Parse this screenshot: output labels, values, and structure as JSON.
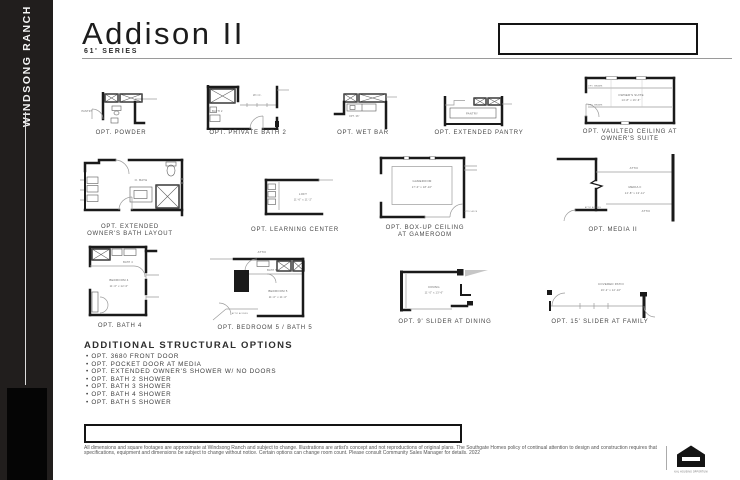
{
  "sidebar": {
    "brand": "WINDSONG RANCH"
  },
  "header": {
    "title": "Addison II",
    "series": "61' SERIES"
  },
  "plans": {
    "powder": {
      "caption": "OPT. POWDER",
      "pantry": "PANTRY"
    },
    "private_bath2": {
      "caption": "OPT. PRIVATE BATH 2",
      "wic": "W.I.C.",
      "bath": "BATH 2"
    },
    "wet_bar": {
      "caption": "OPT. WET BAR",
      "note": "OPT. 36\""
    },
    "ext_pantry": {
      "caption": "OPT. EXTENDED PANTRY",
      "pantry": "PANTRY"
    },
    "vaulted": {
      "caption_1": "OPT. VAULTED CEILING AT",
      "caption_2": "OWNER'S SUITE",
      "room": "OWNER'S SUITE",
      "dims": "14'-8\" x 16'-6\"",
      "beams_top": "OPT. BEAMS",
      "beams_bottom": "OPT. BEAMS"
    },
    "owners_bath": {
      "caption_1": "OPT. EXTENDED",
      "caption_2": "OWNER'S BATH LAYOUT",
      "room": "O. BATH"
    },
    "learning": {
      "caption": "OPT. LEARNING CENTER",
      "room": "LOFT",
      "dims": "11'-6\" x 11'-2\""
    },
    "gameroom": {
      "caption_1": "OPT. BOX-UP CEILING",
      "caption_2": "AT GAMEROOM",
      "room": "GAMEROOM",
      "dims": "17'-0\" x 18'-10\"",
      "attic_access": "ATTIC ACCESS"
    },
    "media2": {
      "caption": "OPT. MEDIA II",
      "room": "MEDIA II",
      "dims": "14'-8\" x 13'-11\"",
      "attic_top": "ATTIC",
      "attic_bottom": "ATTIC",
      "attic_access": "ATTIC ACCESS"
    },
    "bath4": {
      "caption": "OPT. BATH 4",
      "bath": "BATH 4",
      "room": "BEDROOM 4",
      "dims": "11'-0\" x 12'-0\""
    },
    "bedroom5": {
      "caption": "OPT. BEDROOM 5 / BATH 5",
      "attic": "ATTIC",
      "bath": "BATH 5",
      "room": "BEDROOM 5",
      "dims": "11'-0\" x 11'-0\"",
      "attic_access": "ATTIC ACCESS"
    },
    "slider_dining": {
      "caption": "OPT. 9' SLIDER AT DINING",
      "room": "DINING",
      "dims": "11'-0\" x 13'-6\""
    },
    "slider_family": {
      "caption": "OPT. 15' SLIDER AT FAMILY",
      "room": "COVERED PATIO",
      "dims": "16'-2\" x 12'-10\""
    }
  },
  "options": {
    "heading": "ADDITIONAL STRUCTURAL OPTIONS",
    "items": [
      "OPT. 3680 FRONT DOOR",
      "OPT. POCKET DOOR AT MEDIA",
      "OPT. EXTENDED OWNER'S SHOWER W/ NO DOORS",
      "OPT. BATH 2 SHOWER",
      "OPT. BATH 3 SHOWER",
      "OPT. BATH 4 SHOWER",
      "OPT. BATH 5 SHOWER"
    ]
  },
  "footer": {
    "disclaimer": "All dimensions and square footages are approximate at Windsong Ranch and subject to change. Illustrations are artist's concept and not reproductions of original plans. The Southgate Homes policy of continual attention to design and construction requires that specifications, equipment and dimensions be subject to change without notice. Certain options can change room count. Please consult Community Sales Manager for details. 2022",
    "eho_label": "EQUAL HOUSING OPPORTUNITY"
  },
  "colors": {
    "sidebar": "#211e1d",
    "ink": "#1a1a1a",
    "thin_line": "#9b9b9b"
  }
}
